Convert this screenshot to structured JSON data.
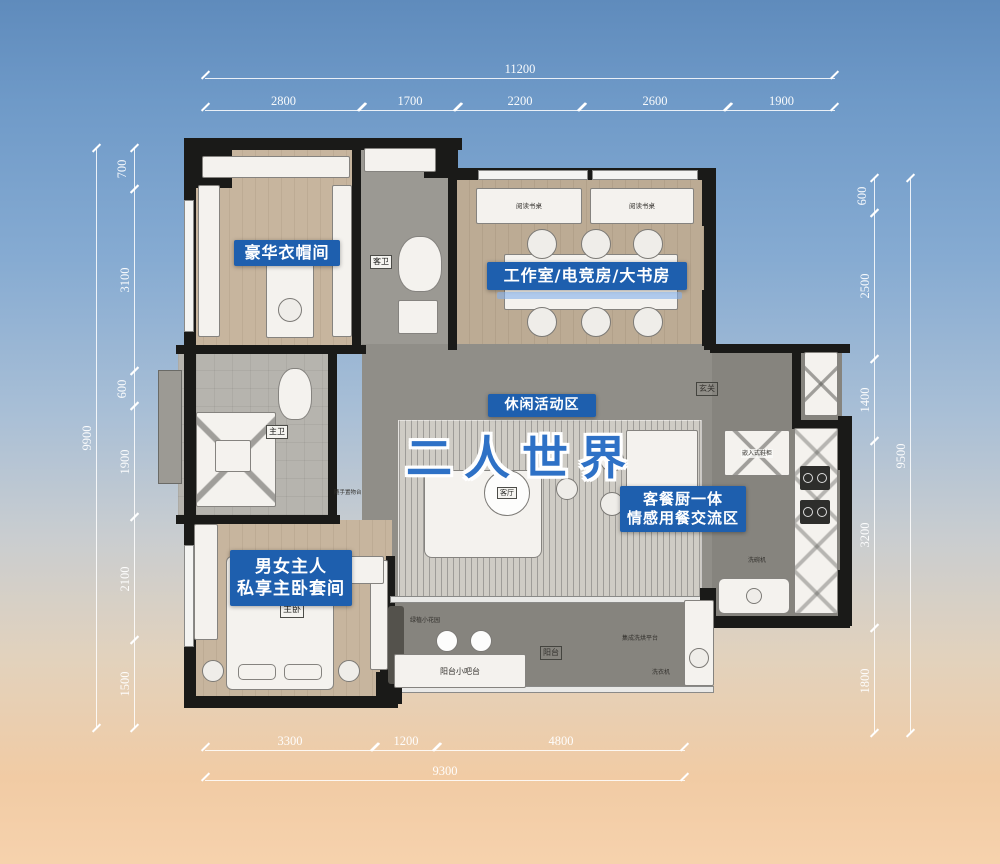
{
  "scene": {
    "title": "二人世界"
  },
  "colors": {
    "label_bg": "#1e5fae",
    "title_blue": "#2e71c6",
    "dim_text": "#ffffff",
    "sky_top": "#5f8bbc",
    "sky_bottom": "#f6d2ad"
  },
  "zones": {
    "wardrobe": "豪华衣帽间",
    "study": "工作室/电竞房/大书房",
    "leisure": "休闲活动区",
    "dining_line1": "客餐厨一体",
    "dining_line2": "情感用餐交流区",
    "master_line1": "男女主人",
    "master_line2": "私享主卧套间"
  },
  "rooms": {
    "guest_bath": "客卫",
    "master_bath": "主卫",
    "living": "客厅",
    "master_bed": "主卧",
    "entry": "玄关",
    "balcony": "阳台",
    "desk": "阅读书桌",
    "bar": "阳台小吧台",
    "shoe_cabinet": "嵌入式鞋柜",
    "dishwasher": "洗碗机",
    "washer": "洗衣机",
    "laundry": "集成洗烘平台",
    "shelf": "随手置物台",
    "garden": "绿植小花园"
  },
  "dimensions": {
    "top": {
      "total": "11200",
      "segments": [
        "2800",
        "1700",
        "2200",
        "2600",
        "1900"
      ]
    },
    "left": {
      "total": "9900",
      "segments": [
        "700",
        "3100",
        "600",
        "1900",
        "2100",
        "1500"
      ]
    },
    "right": {
      "total": "9500",
      "segments": [
        "600",
        "2500",
        "1400",
        "3200",
        "1800"
      ]
    },
    "bottom": {
      "total": "9300",
      "segments": [
        "3300",
        "1200",
        "4800"
      ]
    }
  }
}
